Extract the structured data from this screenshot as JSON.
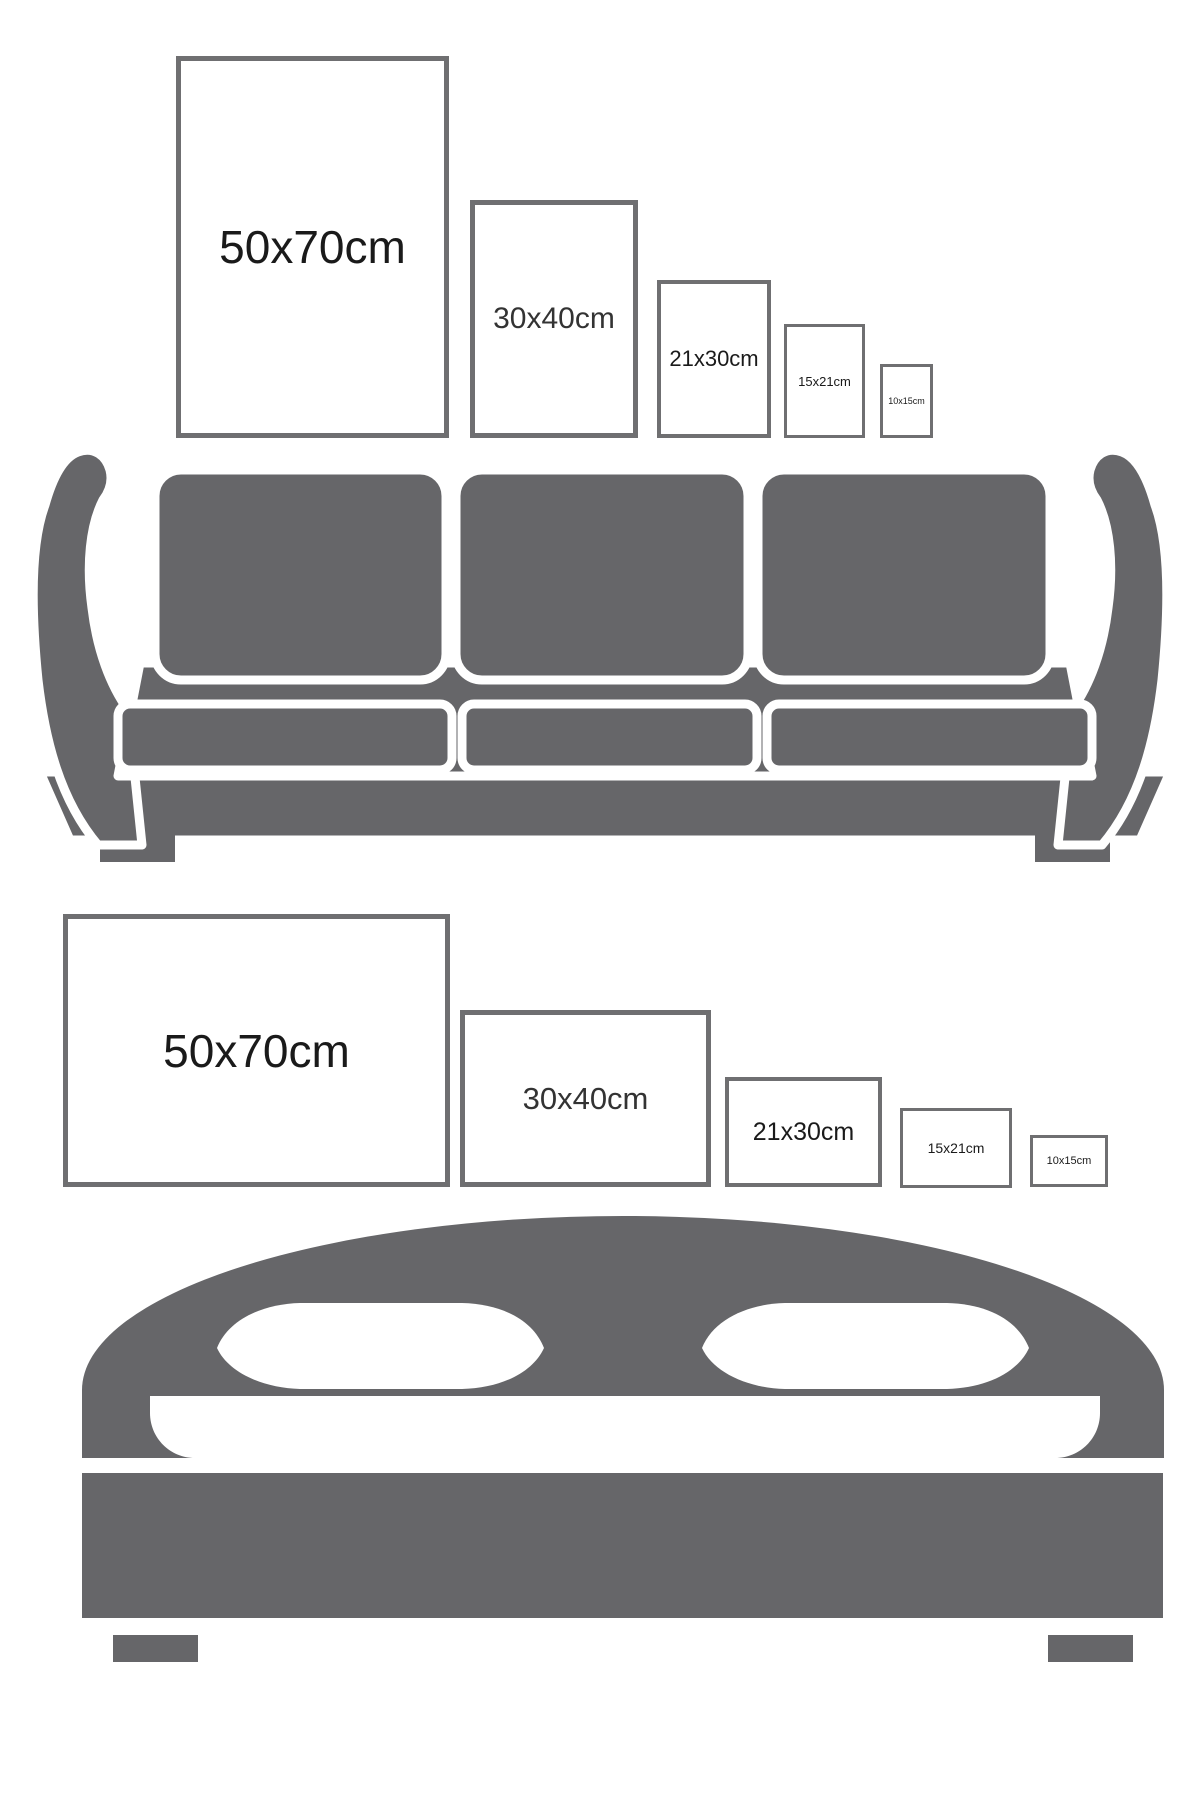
{
  "title": "Poster size comparison guide",
  "colors": {
    "furniture": "#666669",
    "frame_border": "#6f6f71",
    "label_text": "#1a1a1a",
    "background": "#ffffff"
  },
  "portrait_row": {
    "orientation": "portrait",
    "frames": [
      {
        "label": "50x70cm"
      },
      {
        "label": "30x40cm"
      },
      {
        "label": "21x30cm"
      },
      {
        "label": "15x21cm"
      },
      {
        "label": "10x15cm"
      }
    ]
  },
  "landscape_row": {
    "orientation": "landscape",
    "frames": [
      {
        "label": "50x70cm"
      },
      {
        "label": "30x40cm"
      },
      {
        "label": "21x30cm"
      },
      {
        "label": "15x21cm"
      },
      {
        "label": "10x15cm"
      }
    ]
  },
  "icons": [
    {
      "name": "sofa-icon",
      "description": "three-seat sofa silhouette"
    },
    {
      "name": "bed-icon",
      "description": "double bed with headboard silhouette"
    }
  ]
}
